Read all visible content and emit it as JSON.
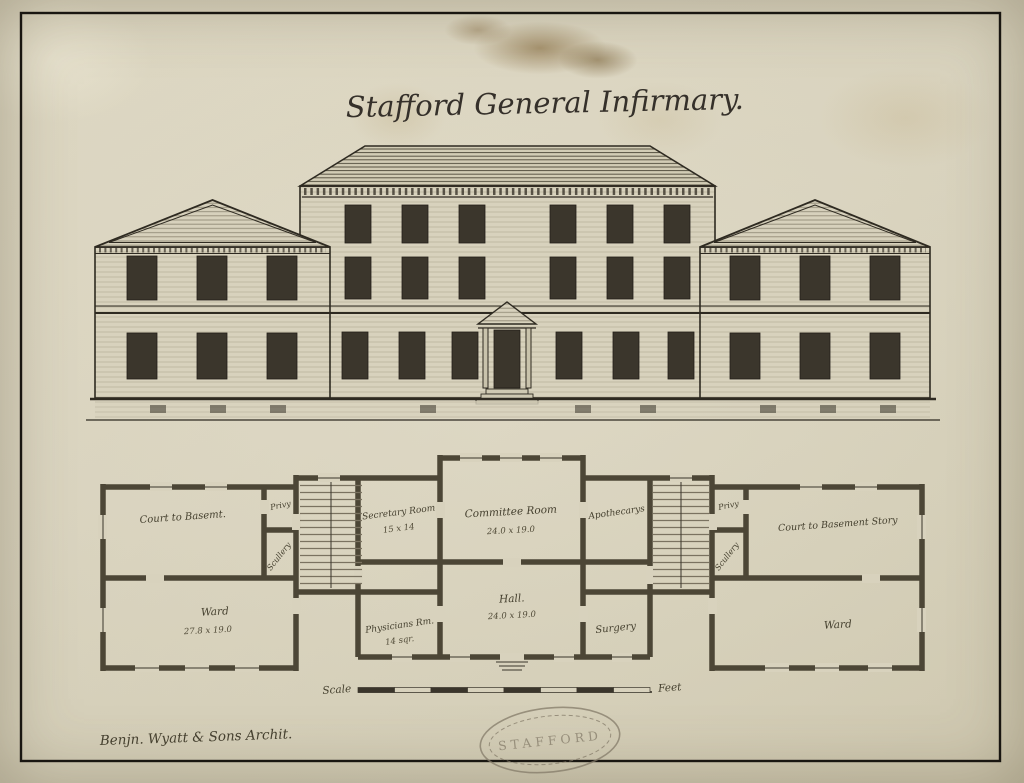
{
  "artwork": {
    "title": "Stafford General Infirmary.",
    "signature": "Benjn. Wyatt & Sons Archit.",
    "stamp": "STAFFORD"
  },
  "scale_bar": {
    "left": "Scale",
    "right": "Feet"
  },
  "colors": {
    "paper": "#d8d2bd",
    "ink": "#2e2a21",
    "wall": "#4c4636",
    "stamp": "#847b69"
  },
  "plan": {
    "rooms": [
      {
        "name": "Court to Basemt.",
        "dims": ""
      },
      {
        "name": "Privy",
        "dims": ""
      },
      {
        "name": "Scullery",
        "dims": ""
      },
      {
        "name": "Ward",
        "dims": "27.8 x 19.0"
      },
      {
        "name": "Secretary Room",
        "dims": "15 x 14"
      },
      {
        "name": "Committee Room",
        "dims": "24.0 x 19.0"
      },
      {
        "name": "Apothecarys",
        "dims": ""
      },
      {
        "name": "Hall.",
        "dims": "24.0 x 19.0"
      },
      {
        "name": "Physicians Rm.",
        "dims": "14 sqr."
      },
      {
        "name": "Surgery",
        "dims": ""
      },
      {
        "name": "Privy",
        "dims": ""
      },
      {
        "name": "Scullery",
        "dims": ""
      },
      {
        "name": "Court to Basement Story",
        "dims": ""
      },
      {
        "name": "Ward",
        "dims": ""
      }
    ]
  }
}
